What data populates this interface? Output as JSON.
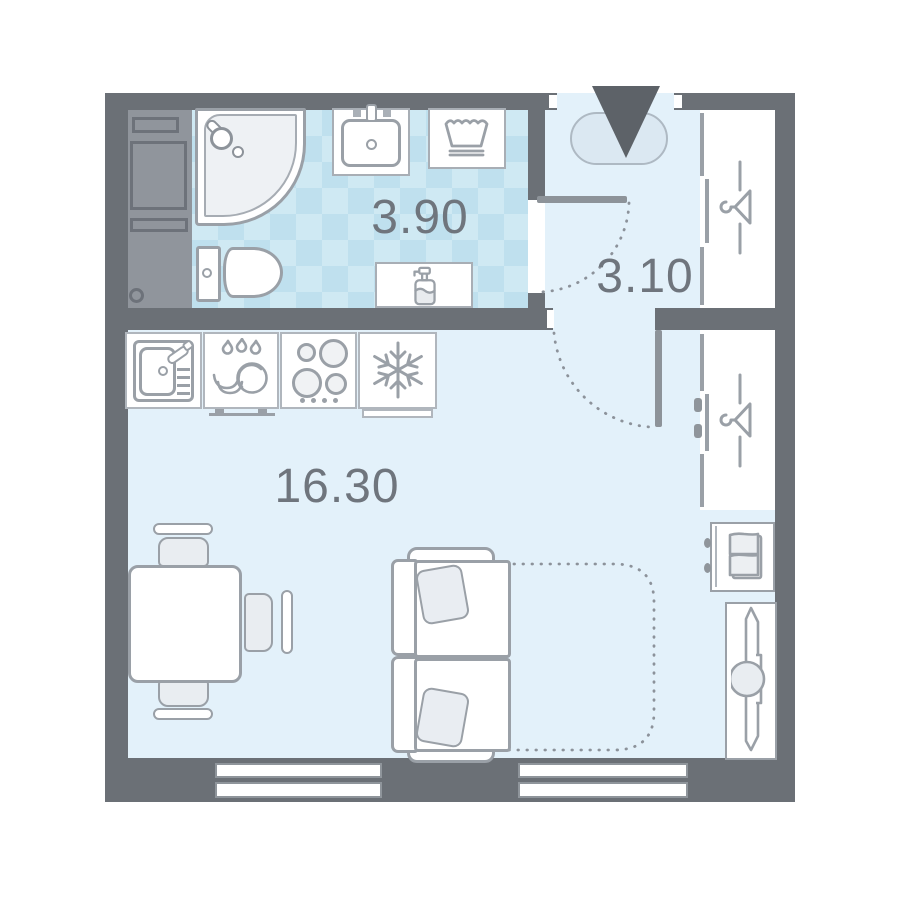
{
  "floorplan": {
    "type": "studio-apartment-floor-plan",
    "rooms": [
      {
        "key": "bathroom",
        "area": "3.90"
      },
      {
        "key": "hallway",
        "area": "3.10"
      },
      {
        "key": "living_kitchen",
        "area": "16.30"
      }
    ],
    "colors": {
      "wall": "#6b7076",
      "floor": "#e3f1fa",
      "tile_base": "#cfe9f3",
      "tile_alt": "#bfe0ee",
      "outline": "#9aa0a7",
      "label": "#6f757d",
      "entrance_arrow": "#5d6268"
    },
    "fixtures": [
      "entrance-arrow",
      "rug",
      "wardrobe-hanger",
      "wardrobe-hanger",
      "shoe-cabinet",
      "ironing-board",
      "shower",
      "washbasin",
      "laundry-basket",
      "toilet",
      "soap-dispenser-shelf",
      "kitchen-sink",
      "dishwasher",
      "hob",
      "fridge",
      "dining-table",
      "chair",
      "chair",
      "chair",
      "sofa-bed",
      "window",
      "window"
    ]
  }
}
